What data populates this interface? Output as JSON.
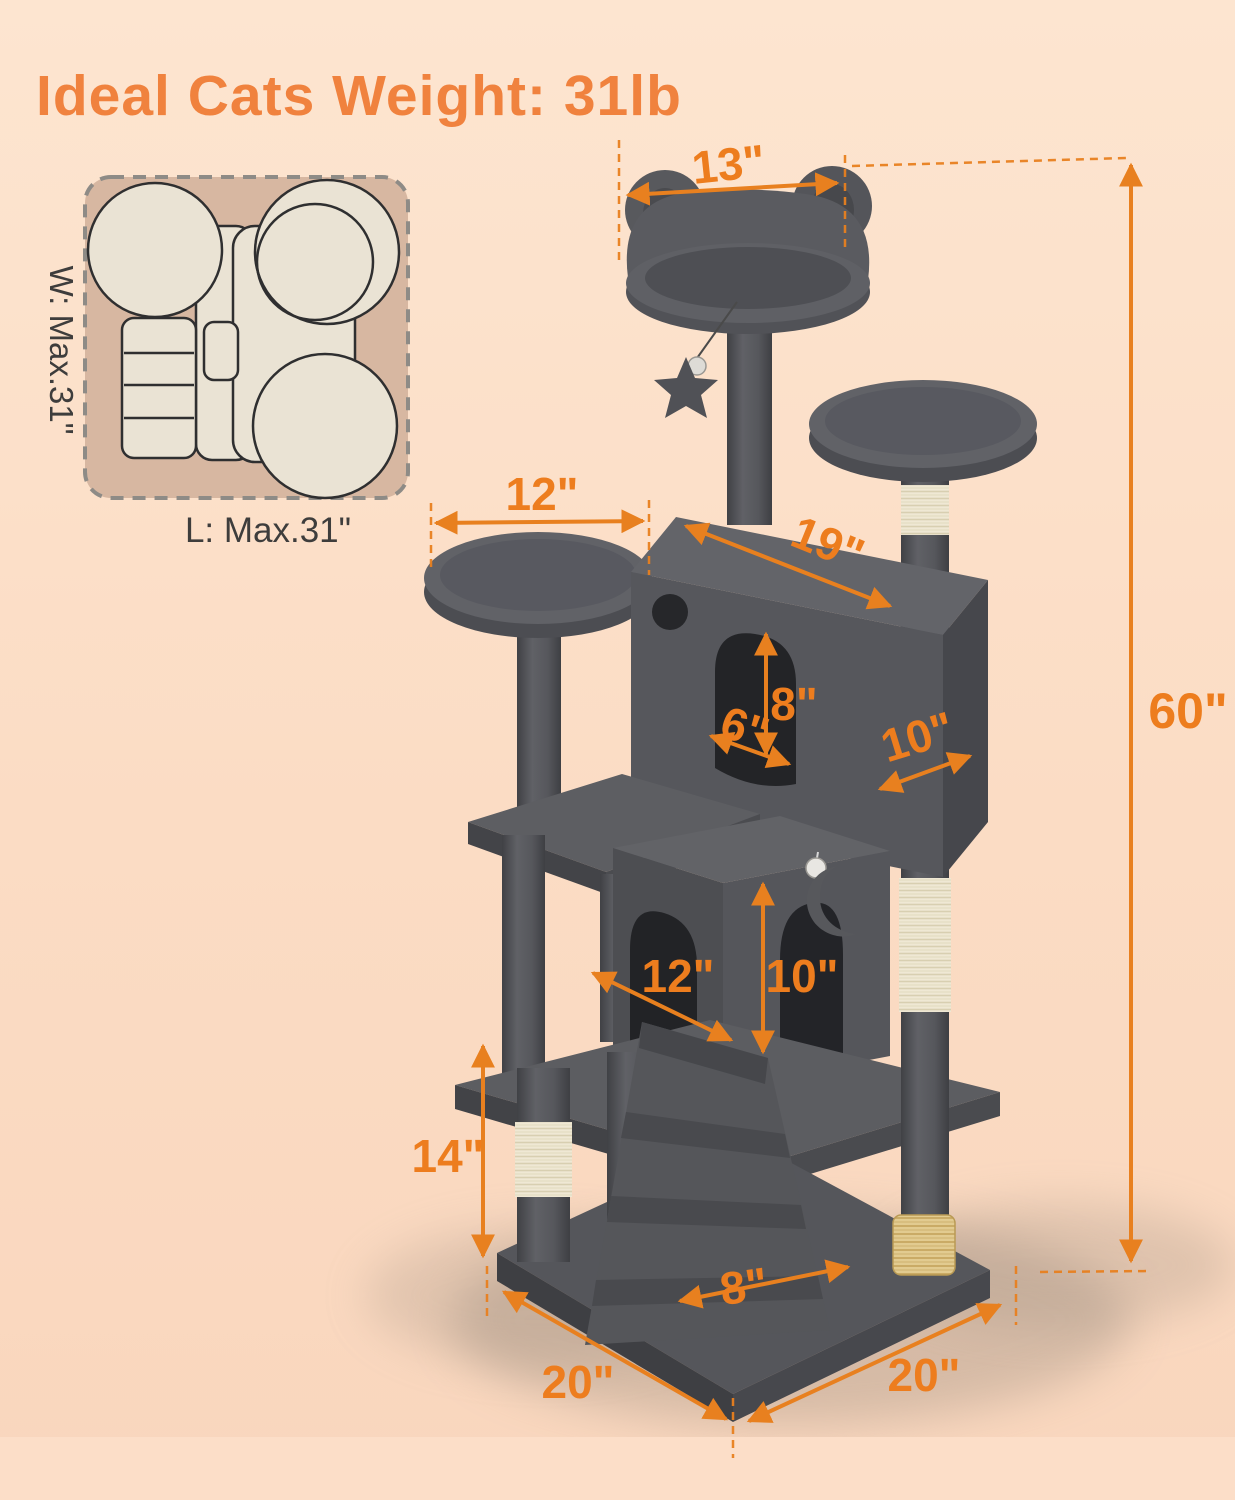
{
  "title": "Ideal Cats Weight: 31lb",
  "footprint": {
    "width_label": "W: Max.31\"",
    "length_label": "L: Max.31\""
  },
  "dims": {
    "top_perch_width": "13\"",
    "left_perch_width": "12\"",
    "condo_length": "19\"",
    "entry_height": "8\"",
    "entry_width": "6\"",
    "condo_depth": "10\"",
    "lower_condo_width": "12\"",
    "lower_condo_height": "10\"",
    "post_height": "14\"",
    "ramp_width": "8\"",
    "base_length": "20\"",
    "base_width": "20\"",
    "total_height": "60\""
  },
  "colors": {
    "accent_orange": "#ED7D1E",
    "title_orange": "#F0823E",
    "tree_gray": "#56575C",
    "tree_gray_dark": "#46474C",
    "hole_dark": "#232428",
    "sisal_cream": "#EFE8D4",
    "brush_tan": "#E2CB90",
    "background_peach": "#FCE2CC",
    "inset_tan": "#D7B7A1",
    "footprint_cream": "#EAE3D4",
    "label_ink": "#3E3D3C"
  }
}
